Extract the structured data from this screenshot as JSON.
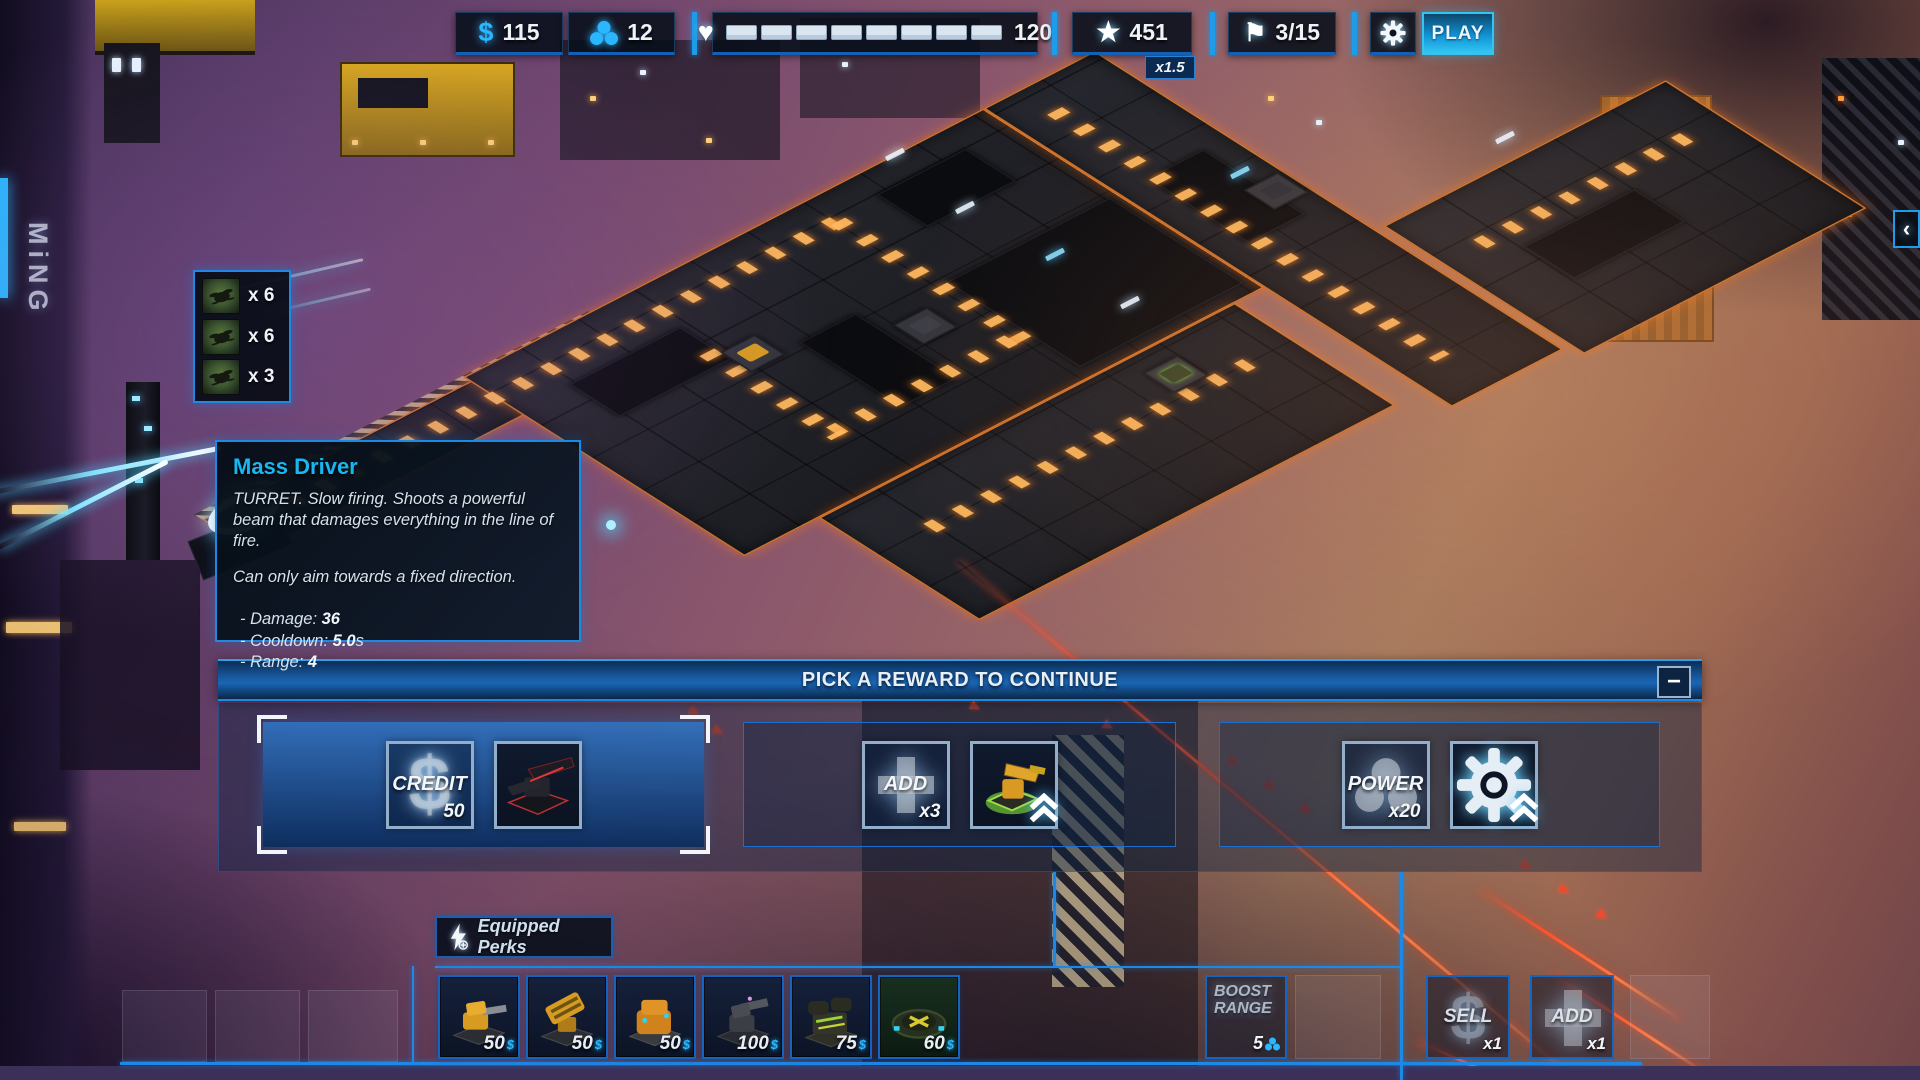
{
  "topbar": {
    "credits": "115",
    "population": "12",
    "health": "120",
    "score": "451",
    "score_multiplier": "x1.5",
    "wave": "3/15",
    "play_label": "PLAY"
  },
  "icons": {
    "dollar": "$",
    "heart": "♥",
    "star": "★",
    "flag": "⚑",
    "minus": "−",
    "collapse": "‹",
    "shop_currency": "$"
  },
  "enemy_preview": {
    "rows": [
      {
        "count": "x 6"
      },
      {
        "count": "x 6"
      },
      {
        "count": "x 3"
      }
    ]
  },
  "tooltip": {
    "title": "Mass Driver",
    "line1": "TURRET.   Slow firing. Shoots a powerful beam that damages everything in the line of fire.",
    "line2": "Can only aim towards a fixed direction.",
    "stats": [
      {
        "label": "- Damage: ",
        "value": "36",
        "suffix": ""
      },
      {
        "label": "- Cooldown: ",
        "value": "5.0",
        "suffix": "s"
      },
      {
        "label": "- Range: ",
        "value": "4",
        "suffix": ""
      }
    ]
  },
  "reward_panel": {
    "title": "PICK A REWARD TO CONTINUE",
    "cards": [
      {
        "kind": "CREDIT",
        "amount": "50"
      },
      {
        "kind": "ADD",
        "amount": "x3"
      },
      {
        "kind": "POWER",
        "amount": "x20"
      }
    ]
  },
  "perks": {
    "label": "Equipped Perks"
  },
  "shop": {
    "items": [
      {
        "price": "50"
      },
      {
        "price": "50"
      },
      {
        "price": "50"
      },
      {
        "price": "100"
      },
      {
        "price": "75"
      },
      {
        "price": "60"
      }
    ]
  },
  "actions": {
    "boost_range": {
      "line1": "BOOST",
      "line2": "RANGE",
      "value": "5"
    },
    "sell": {
      "label": "SELL",
      "count": "x1"
    },
    "add": {
      "label": "ADD",
      "count": "x1"
    }
  },
  "scene": {
    "sign_text": "MiNG"
  },
  "colors": {
    "accent_cyan": "#2bb7ff",
    "panel_blue": "#1565c0",
    "path_orange": "#ff9a3a",
    "alert_red": "#ef4a2e",
    "selected_card_blue": "#2a73c4",
    "health_segment": "#d9e6f2"
  }
}
